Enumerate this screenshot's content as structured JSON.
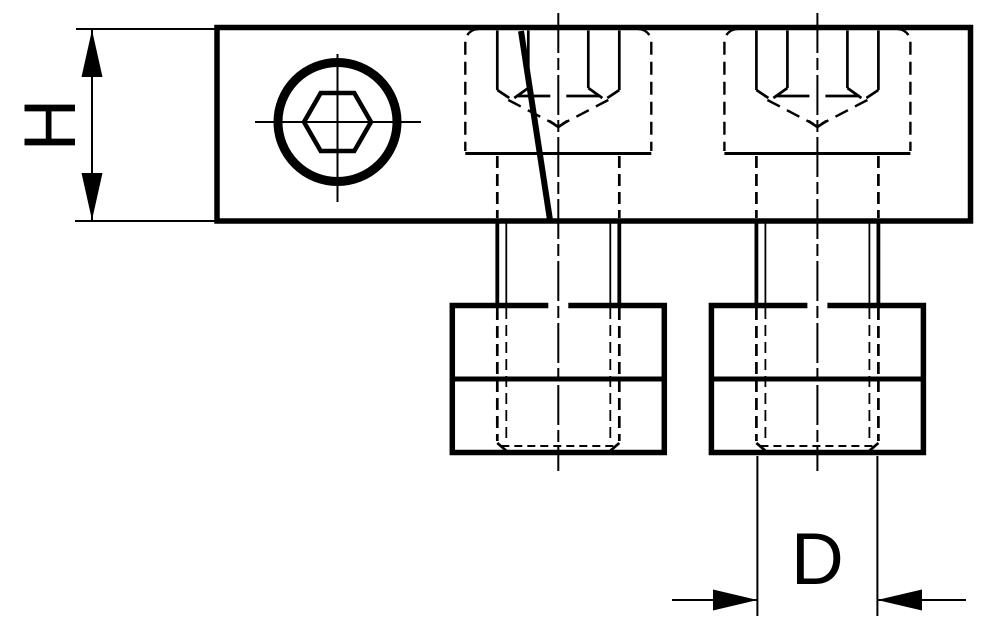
{
  "drawing": {
    "kind": "technical line drawing",
    "view": "side elevation of a clamping bar with two socket head cap screws threaded into T-slot nuts, plus a top view of one socket head screw",
    "background_color": "#ffffff",
    "line_color": "#000000",
    "labels": {
      "height_dimension": "H",
      "diameter_dimension": "D"
    },
    "dimensions": [
      {
        "label": "H",
        "orientation": "vertical",
        "position": "left of bar"
      },
      {
        "label": "D",
        "orientation": "horizontal",
        "position": "below right nut"
      }
    ]
  }
}
